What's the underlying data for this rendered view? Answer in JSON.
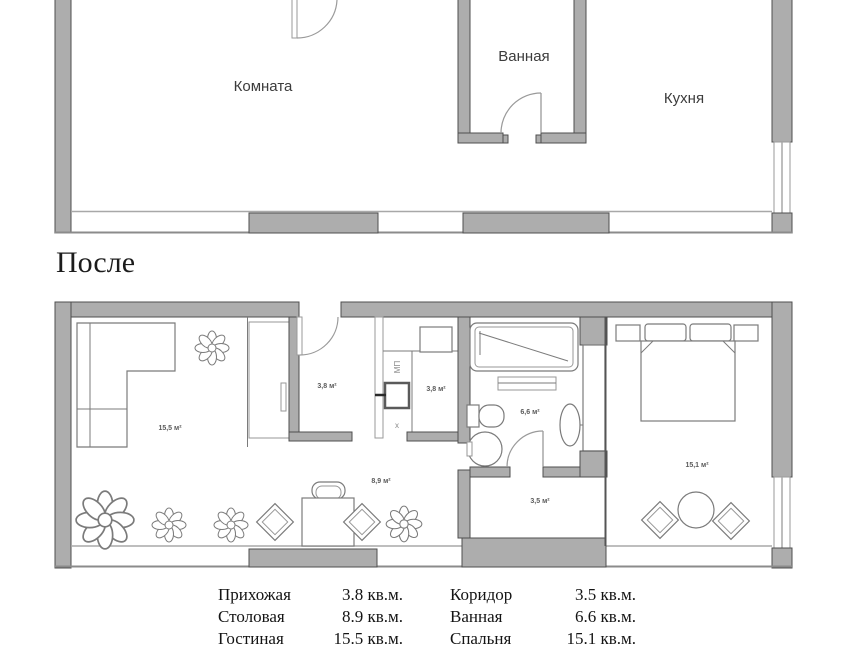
{
  "plan_before": {
    "room_labels": {
      "room": "Комната",
      "bathroom": "Ванная",
      "kitchen": "Кухня"
    }
  },
  "after_heading": "После",
  "plan_after": {
    "area_labels": {
      "living_room": "15,5 м²",
      "hallway": "3,8 м²",
      "kitchen": "3,8 м²",
      "bathroom": "6,6 м²",
      "corridor": "3,5 м²",
      "dining": "8,9 м²",
      "bedroom": "15,1 м²"
    },
    "appliance_labels": {
      "dishwasher": "МП",
      "hob": "х"
    }
  },
  "legend": {
    "rows": [
      {
        "name": "Прихожая",
        "area": "3.8 кв.м."
      },
      {
        "name": "Столовая",
        "area": "8.9 кв.м."
      },
      {
        "name": "Гостиная",
        "area": "15.5 кв.м."
      },
      {
        "name": "Коридор",
        "area": "3.5 кв.м."
      },
      {
        "name": "Ванная",
        "area": "6.6 кв.м."
      },
      {
        "name": "Спальня",
        "area": "15.1 кв.м."
      }
    ]
  },
  "colors": {
    "wall_fill": "#adadad",
    "wall_border": "#4f4f4f",
    "furniture_line": "#7b7b7b",
    "text_dark": "#1c1c1c",
    "plan_label": "#3c3c3c"
  }
}
